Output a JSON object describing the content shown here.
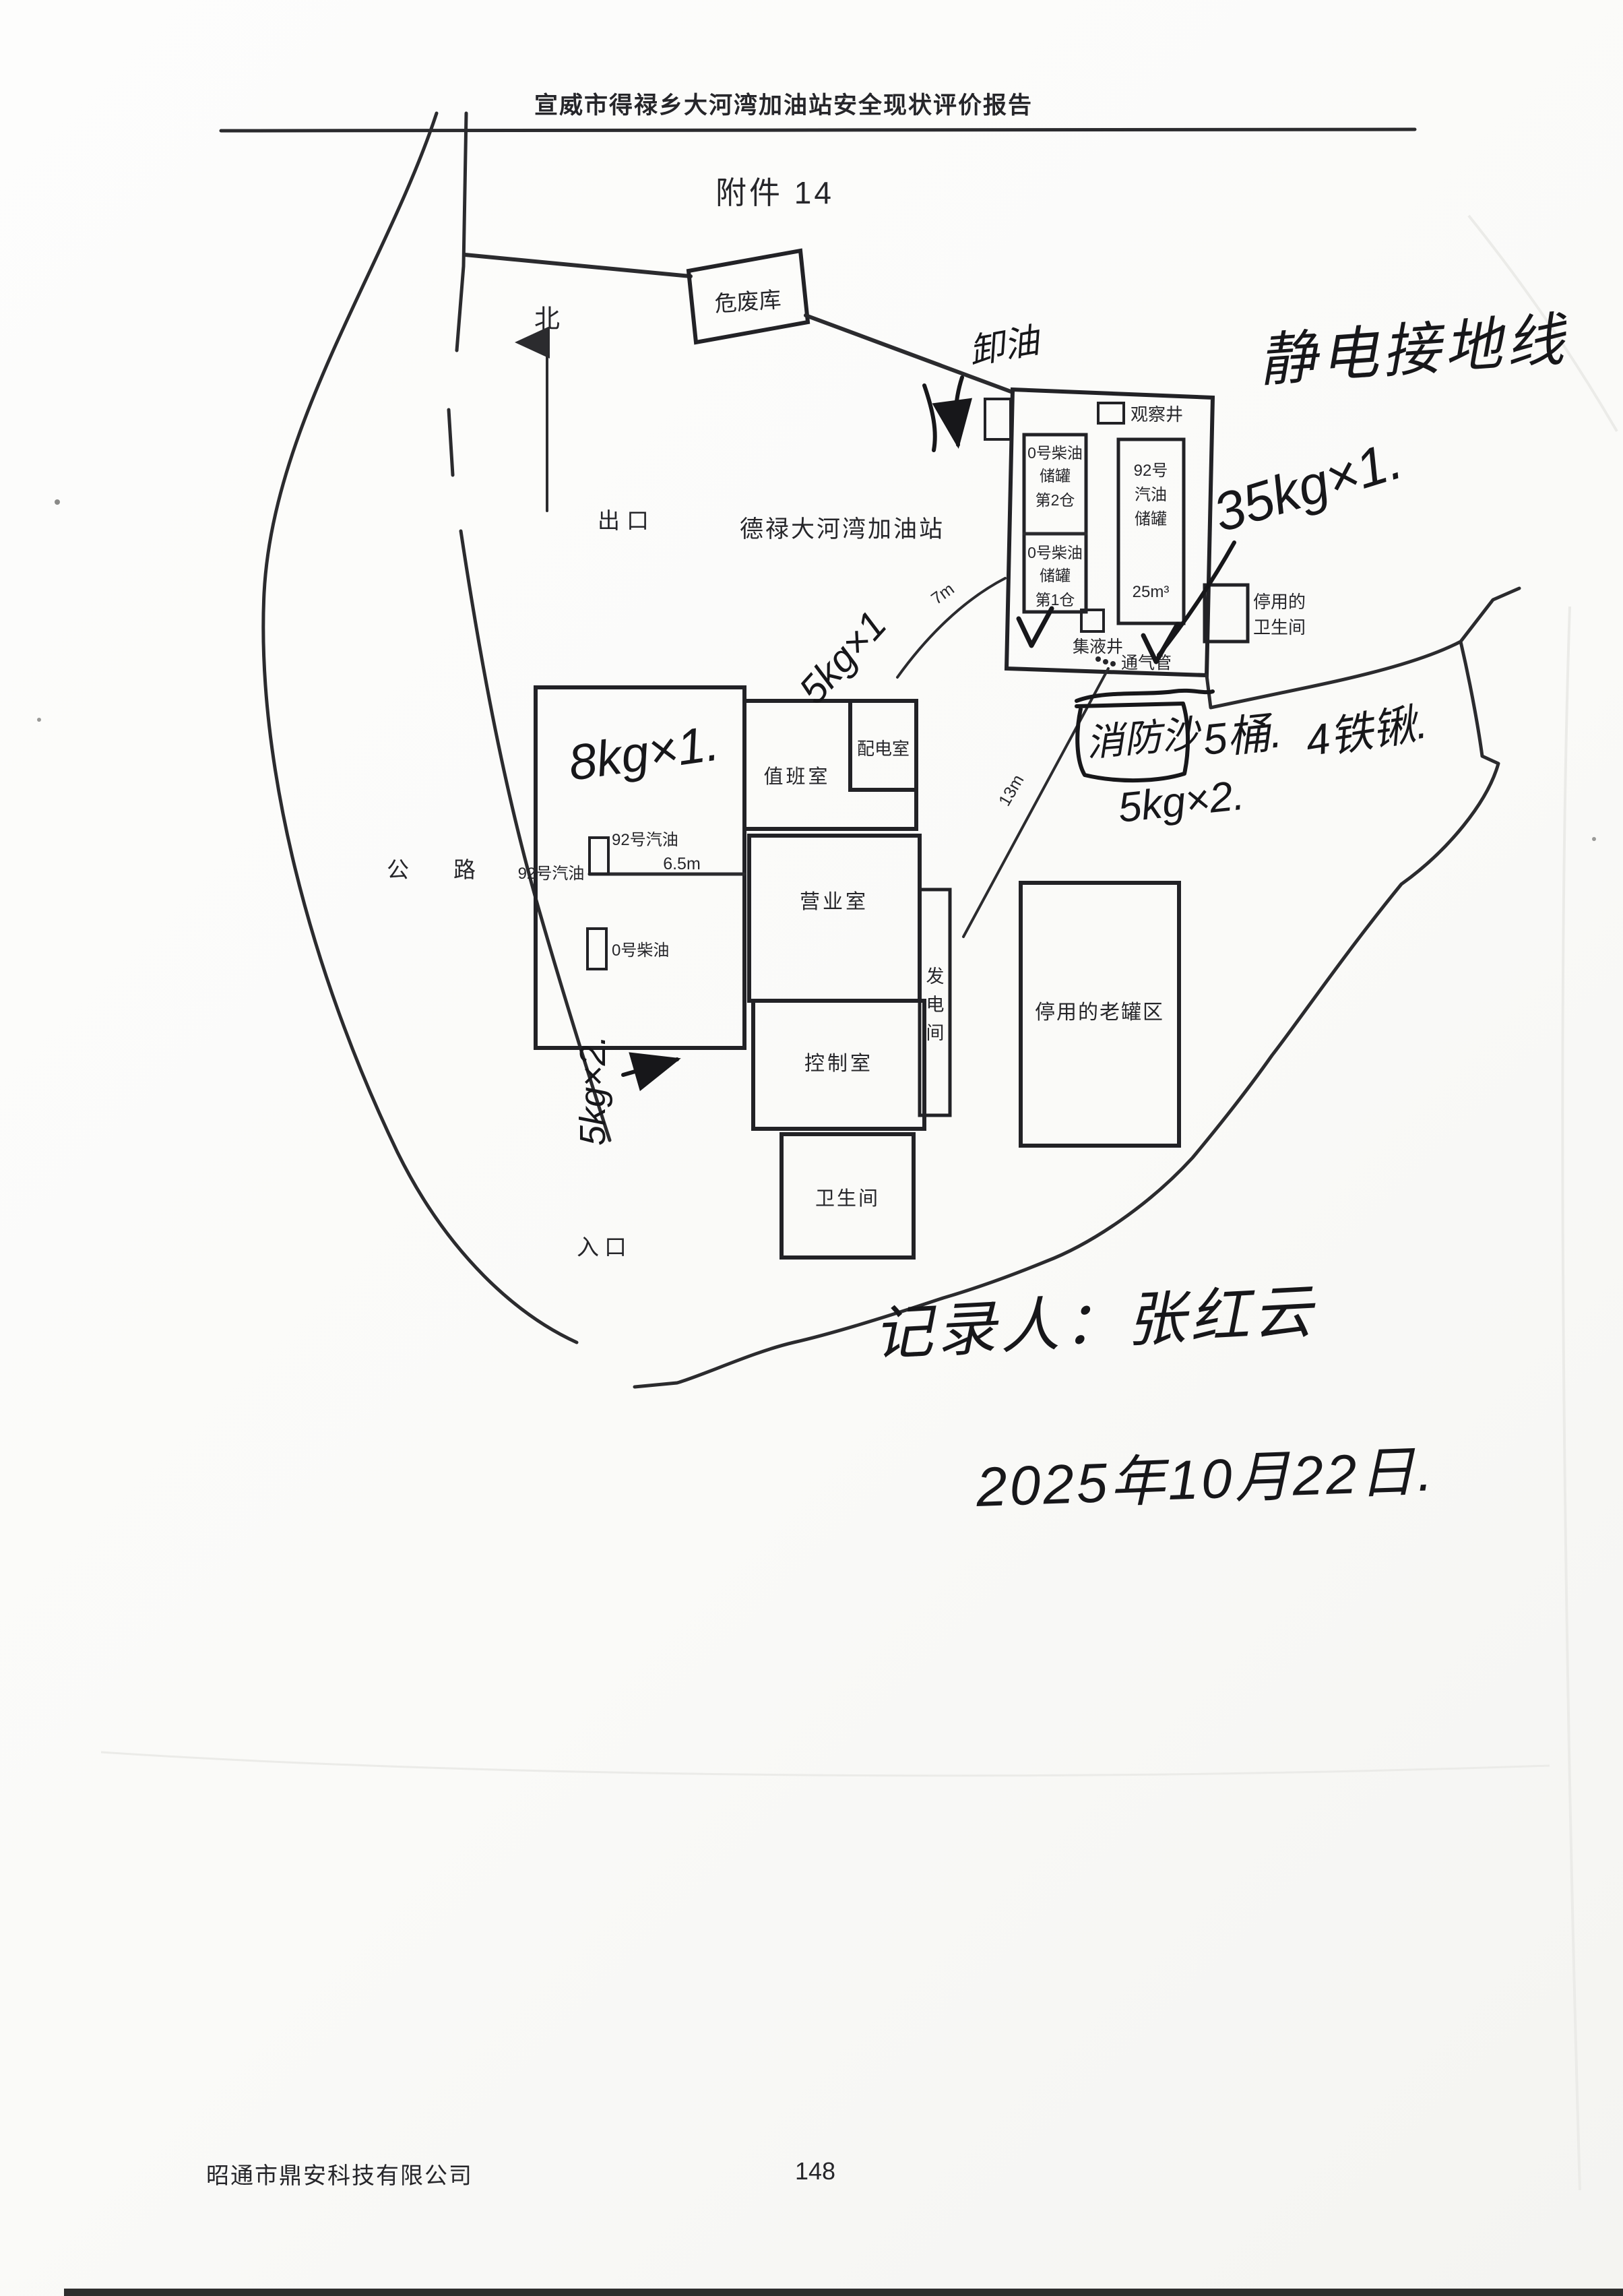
{
  "page": {
    "header_title": "宣威市得禄乡大河湾加油站安全现状评价报告",
    "attachment_label": "附件 14",
    "footer_company": "昭通市鼎安科技有限公司",
    "page_number": "148"
  },
  "colors": {
    "paper": "#fbfbf9",
    "printed_ink": "#26262a",
    "handwriting_ink": "#17171a"
  },
  "site": {
    "north_label": "北",
    "station_name": "德禄大河湾加油站",
    "exit_label": "出口",
    "entrance_label": "入口",
    "road_label": "公　　路"
  },
  "hazwaste": {
    "label": "危废库"
  },
  "tank_area": {
    "observation_well": "观察井",
    "diesel_tank_2": [
      "0号柴油",
      "储罐",
      "第2仓"
    ],
    "diesel_tank_1": [
      "0号柴油",
      "储罐",
      "第1仓"
    ],
    "gasoline_tank": [
      "92号",
      "汽油",
      "储罐"
    ],
    "gasoline_tank_volume": "25m³",
    "collection_well": "集液井",
    "vent_pipe": "通气管",
    "disused_toilet_line1": "停用的",
    "disused_toilet_line2": "卫生间"
  },
  "buildings": {
    "duty_room": "值班室",
    "power_room": "配电室",
    "business_room": "营业室",
    "generator_room": [
      "发",
      "电",
      "间"
    ],
    "control_room": "控制室",
    "toilet": "卫生间",
    "old_tank_area": "停用的老罐区"
  },
  "dispensers": {
    "g92_island_label": "92号汽油",
    "g92_side_label": "92号汽油",
    "d0_island_label": "0号柴油"
  },
  "dimensions": {
    "d7": "7m",
    "d13": "13m",
    "d65": "6.5m"
  },
  "handwriting": {
    "top_right_note": "静电接地线",
    "tank_extinguisher": "35kg×1.",
    "canopy_extinguisher": "8kg×1.",
    "power_room_extinguisher": "5kg×1",
    "unloading_note": "卸油",
    "fire_sand": "消防沙",
    "sand_buckets": "5桶.",
    "shovels": "4铁锹.",
    "old_area_extinguisher": "5kg×2.",
    "island_extinguisher_vertical": "5kg×2.",
    "recorder_line": "记录人：张红云",
    "date_line": "2025年10月22日."
  }
}
